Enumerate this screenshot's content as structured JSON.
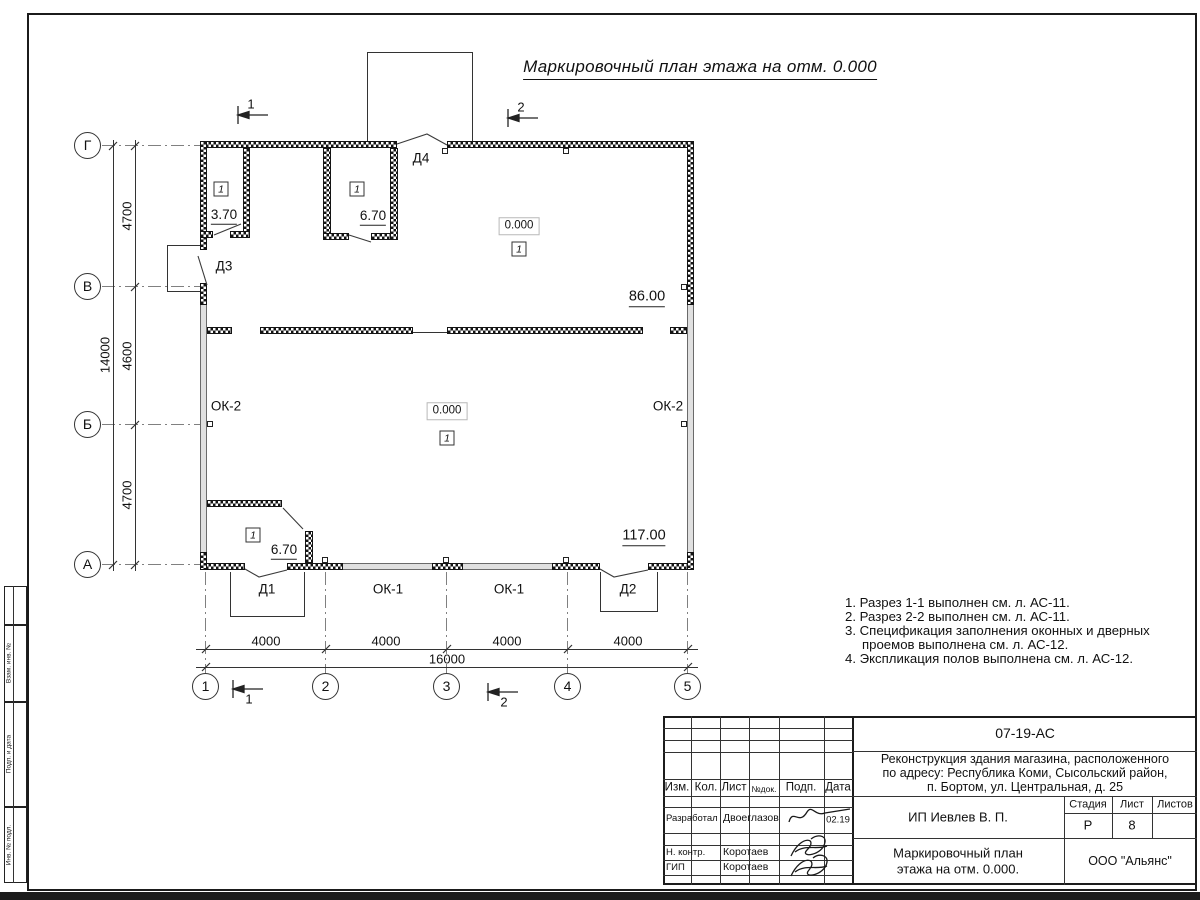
{
  "sheet_title": "Маркировочный план этажа на отм. 0.000",
  "plan": {
    "axis_letters": [
      "Г",
      "В",
      "Б",
      "А"
    ],
    "axis_numbers": [
      "1",
      "2",
      "3",
      "4",
      "5"
    ],
    "dims_left": [
      "4700",
      "4600",
      "4700"
    ],
    "dim_left_total": "14000",
    "dims_bottom": [
      "4000",
      "4000",
      "4000",
      "4000"
    ],
    "dim_bottom_total": "16000",
    "sections": {
      "s1": "1",
      "s2": "2"
    },
    "doors": {
      "d1": "Д1",
      "d2": "Д2",
      "d3": "Д3",
      "d4": "Д4"
    },
    "windows": {
      "ok1": "ОК-1",
      "ok2": "ОК-2"
    },
    "marks": {
      "elev": "0.000",
      "type": "1",
      "area_r1": "3.70",
      "area_r2": "6.70",
      "area_hall_up": "86.00",
      "area_hall_low": "117.00",
      "area_r3": "6.70"
    }
  },
  "notes": {
    "l1": "1. Разрез 1-1 выполнен см. л. АС-11.",
    "l2": "2. Разрез 2-2 выполнен см. л. АС-11.",
    "l3": "3. Спецификация заполнения оконных и дверных",
    "l3b": "проемов выполнена см. л. АС-12.",
    "l4": "4. Экспликация полов выполнена см. л. АС-12."
  },
  "stamp": {
    "code": "07-19-АС",
    "project_l1": "Реконструкция здания магазина, расположенного",
    "project_l2": "по адресу: Республика Коми, Сысольский район,",
    "project_l3": "п. Бортом, ул. Центральная, д. 25",
    "cols": {
      "izm": "Изм.",
      "kol": "Кол.",
      "list": "Лист",
      "ndok": "№док.",
      "podp": "Подп.",
      "data": "Дата"
    },
    "rows": {
      "r1_role": "Разработал",
      "r1_name": "Двоеглазов",
      "r1_date": "02.19",
      "r2_role": "Н. контр.",
      "r2_name": "Коротаев",
      "r3_role": "ГИП",
      "r3_name": "Коротаев"
    },
    "client": "ИП Иевлев В. П.",
    "stage_label": "Стадия",
    "sheet_label": "Лист",
    "sheets_label": "Листов",
    "stage": "Р",
    "sheet_no": "8",
    "title_l1": "Маркировочный план",
    "title_l2": "этажа на отм. 0.000.",
    "company": "ООО \"Альянс\""
  },
  "side_stamp": {
    "b1": "Взам. инв. №",
    "b2": "Подп. и дата",
    "b3": "Инв. № подл."
  }
}
